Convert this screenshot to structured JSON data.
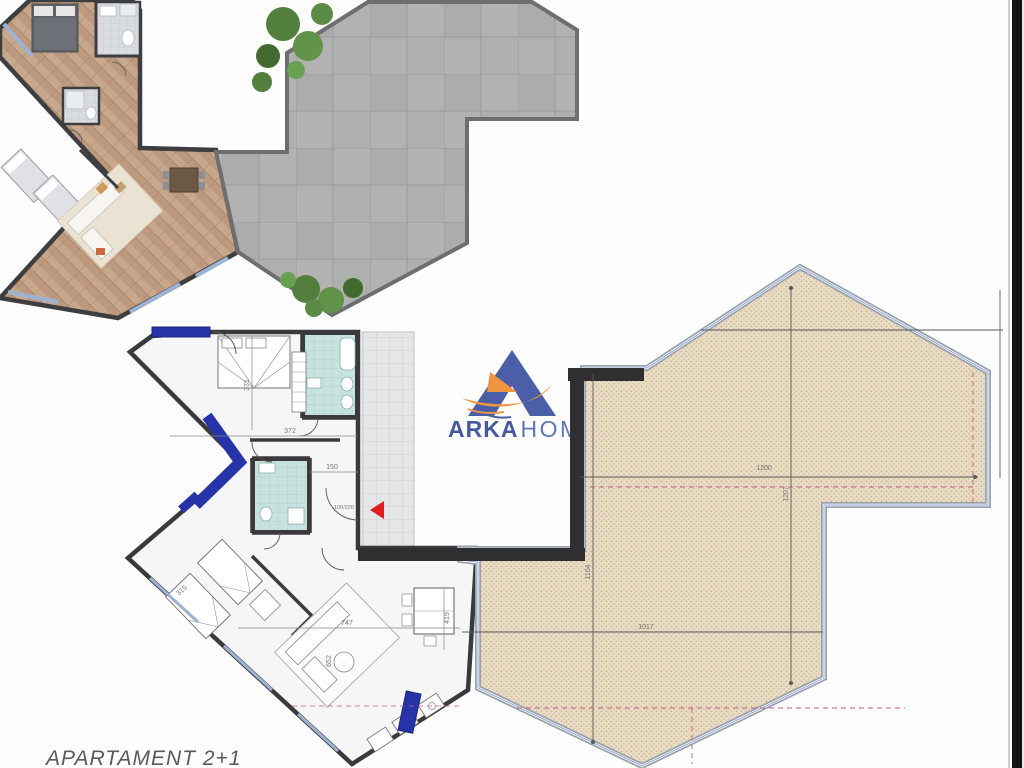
{
  "logo": {
    "brand_primary": "ARKA",
    "brand_secondary": "HOME"
  },
  "caption": {
    "label": "APARTAMENT  2+1"
  },
  "technical_plan": {
    "dimensions": {
      "bedroom_width": "371",
      "hall_width": "372",
      "hall_depth": "150",
      "entry_door": "100/220",
      "bedroom2_side": "315",
      "living_width": "747",
      "living_depth": "652",
      "dining_depth": "419"
    }
  },
  "roof_terrace": {
    "dimensions": {
      "mid_width": "1200",
      "mid_height": "1207",
      "left_height": "1104",
      "bottom_width": "1017"
    }
  },
  "colors": {
    "logo_blue": "#4a5fa8",
    "logo_orange": "#ef9440",
    "accent_blue": "#2733a8",
    "entry_arrow_red": "#e02020",
    "terrace_hatch": "#e9dcc4",
    "paved_terrace": "#b2b2b2"
  }
}
